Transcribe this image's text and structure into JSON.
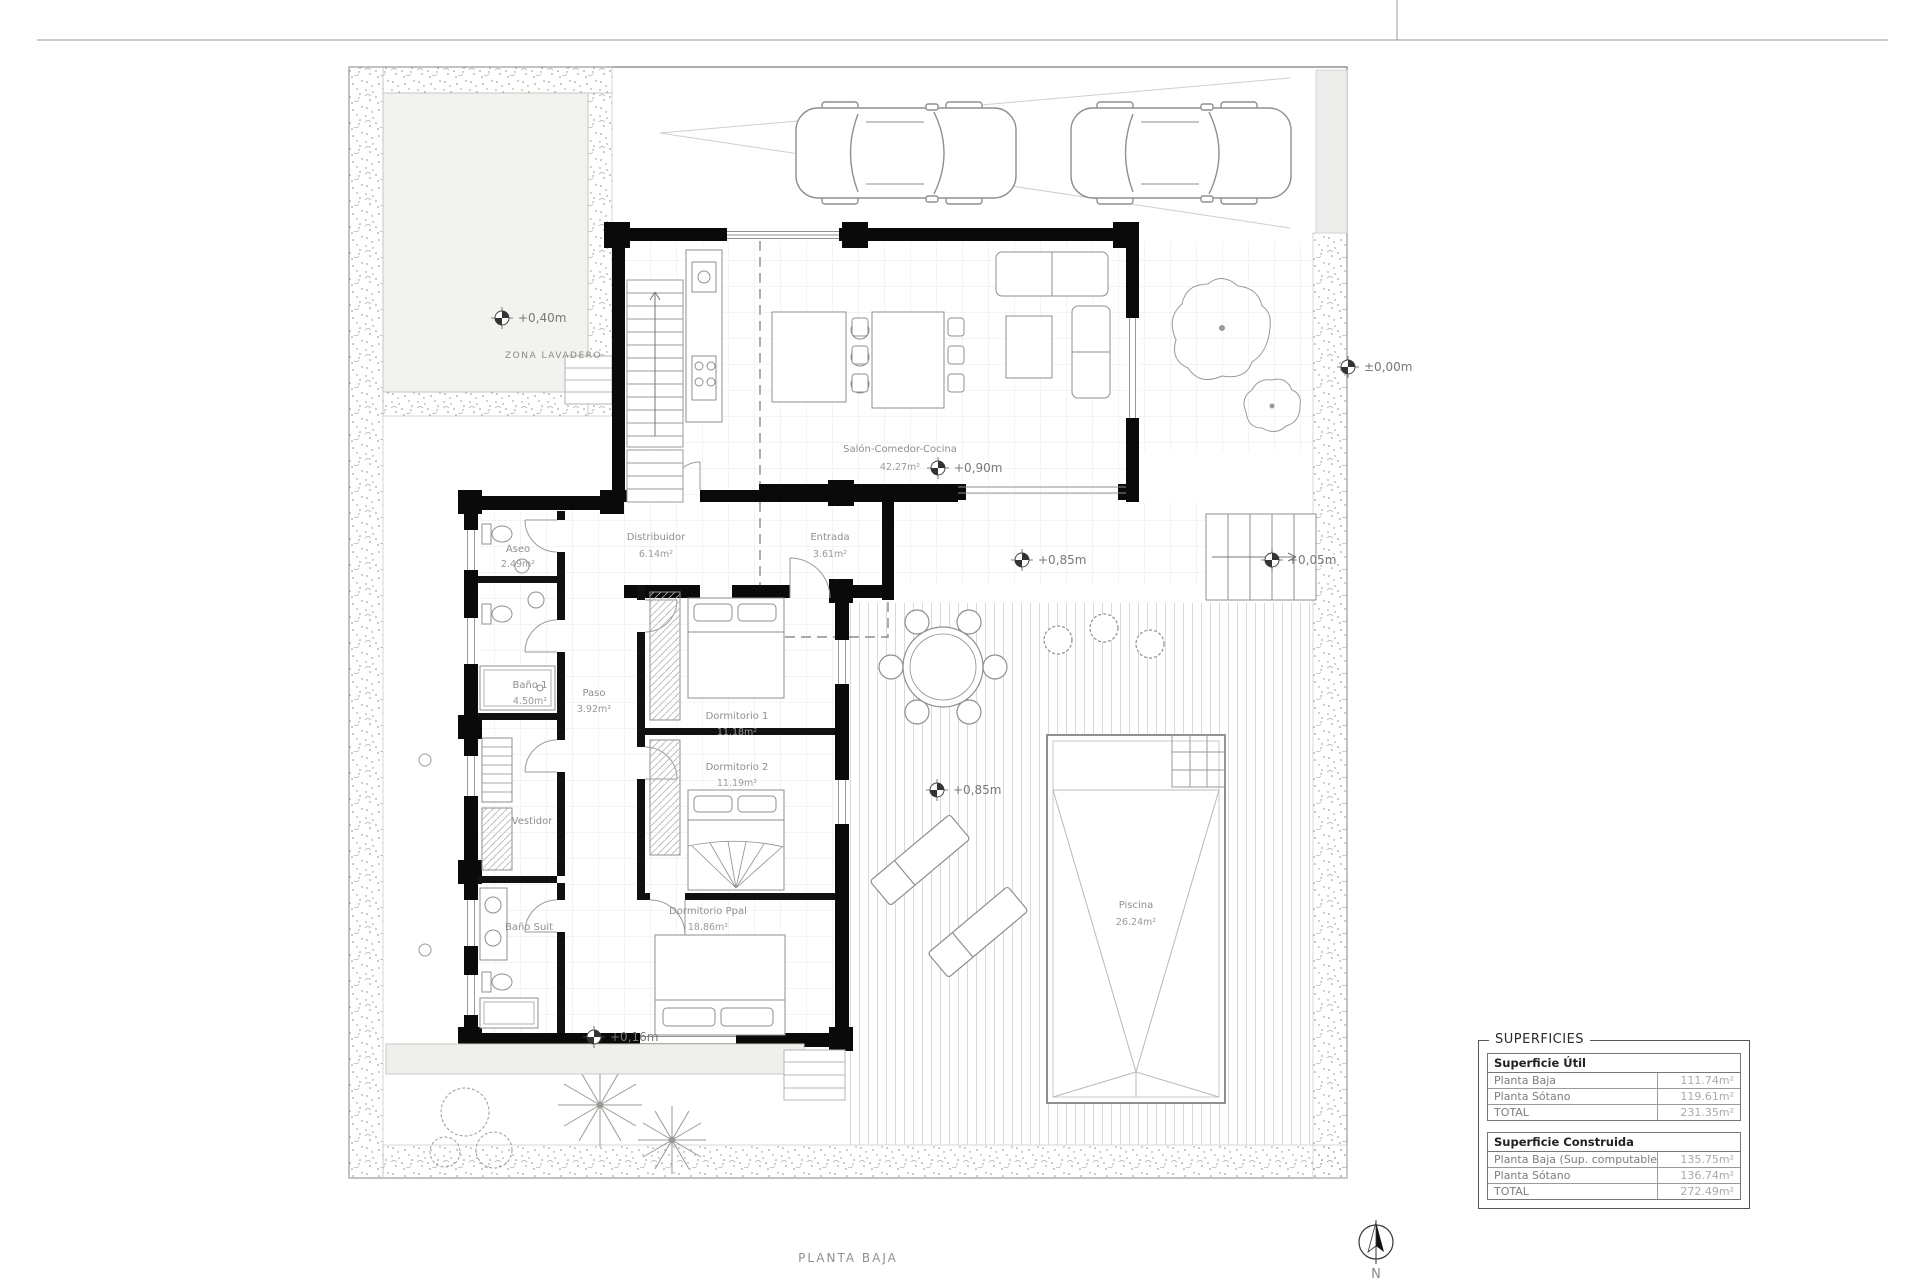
{
  "title": "PLANTA BAJA",
  "north": "N",
  "labels": {
    "zona_lavadero": "ZONA LAVADERO"
  },
  "rooms": {
    "salon": {
      "name": "Salón-Comedor-Cocina",
      "area": "42.27m²"
    },
    "distribuidor": {
      "name": "Distribuidor",
      "area": "6.14m²"
    },
    "entrada": {
      "name": "Entrada",
      "area": "3.61m²"
    },
    "aseo": {
      "name": "Aseo",
      "area": "2.49m²"
    },
    "bano1": {
      "name": "Baño 1",
      "area": "4.50m²"
    },
    "paso": {
      "name": "Paso",
      "area": "3.92m²"
    },
    "dorm1": {
      "name": "Dormitorio 1",
      "area": "11.18m²"
    },
    "dorm2": {
      "name": "Dormitorio 2",
      "area": "11.19m²"
    },
    "vestidor": {
      "name": "Vestidor"
    },
    "bano_suit": {
      "name": "Baño Suit"
    },
    "dorm_ppal": {
      "name": "Dormitorio Ppal",
      "area": "18.86m²"
    },
    "piscina": {
      "name": "Piscina",
      "area": "26.24m²"
    }
  },
  "levels": {
    "lavadero": "+0,40m",
    "salon": "+0,90m",
    "porche": "+0,85m",
    "escalera": "+0,05m",
    "calle": "±0,00m",
    "terraza": "+0,85m",
    "jardin": "+0,16m"
  },
  "surfaces": {
    "panel_title": "SUPERFICIES",
    "util": {
      "title": "Superficie Útil",
      "rows": [
        {
          "label": "Planta Baja",
          "value": "111.74m²"
        },
        {
          "label": "Planta Sótano",
          "value": "119.61m²"
        },
        {
          "label": "TOTAL",
          "value": "231.35m²"
        }
      ]
    },
    "construida": {
      "title": "Superficie Construida",
      "rows": [
        {
          "label": "Planta Baja (Sup. computable)",
          "value": "135.75m²"
        },
        {
          "label": "Planta Sótano",
          "value": "136.74m²"
        },
        {
          "label": "TOTAL",
          "value": "272.49m²"
        }
      ]
    }
  },
  "colors": {
    "wall": "#0a0a0a",
    "line": "#8f8f8c",
    "grid": "#e9e9e6",
    "text": "#8a8a88"
  }
}
